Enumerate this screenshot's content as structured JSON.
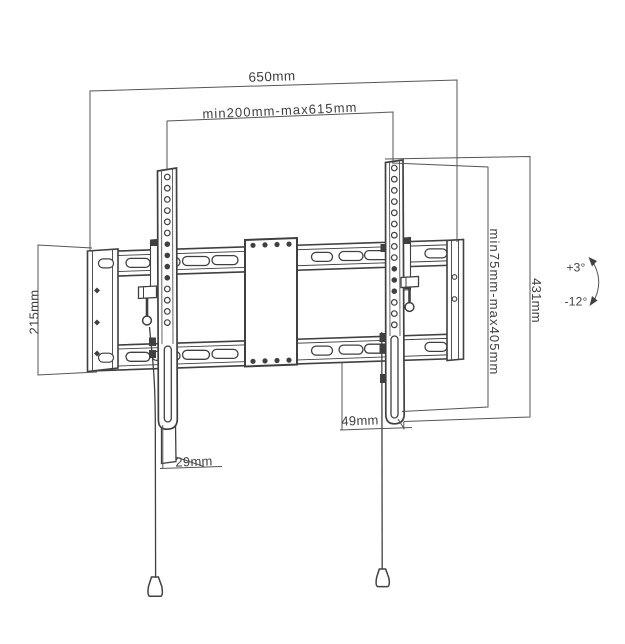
{
  "page": {
    "background": "#ffffff"
  },
  "colors": {
    "hardware_line": "#404040",
    "dimension_line": "#555555",
    "label_text": "#3f3f3f"
  },
  "diagram": {
    "dimensions": {
      "total_width": "650mm",
      "arm_spacing_range": "min200mm-max615mm",
      "wall_plate_height": "215mm",
      "vesa_height_range": "min75mm-max405mm",
      "bracket_height": "431mm",
      "right_bottom_offset": "49mm",
      "left_bottom_offset": "29mm"
    },
    "tilt_range": {
      "up": "+3°",
      "down": "-12°"
    }
  }
}
